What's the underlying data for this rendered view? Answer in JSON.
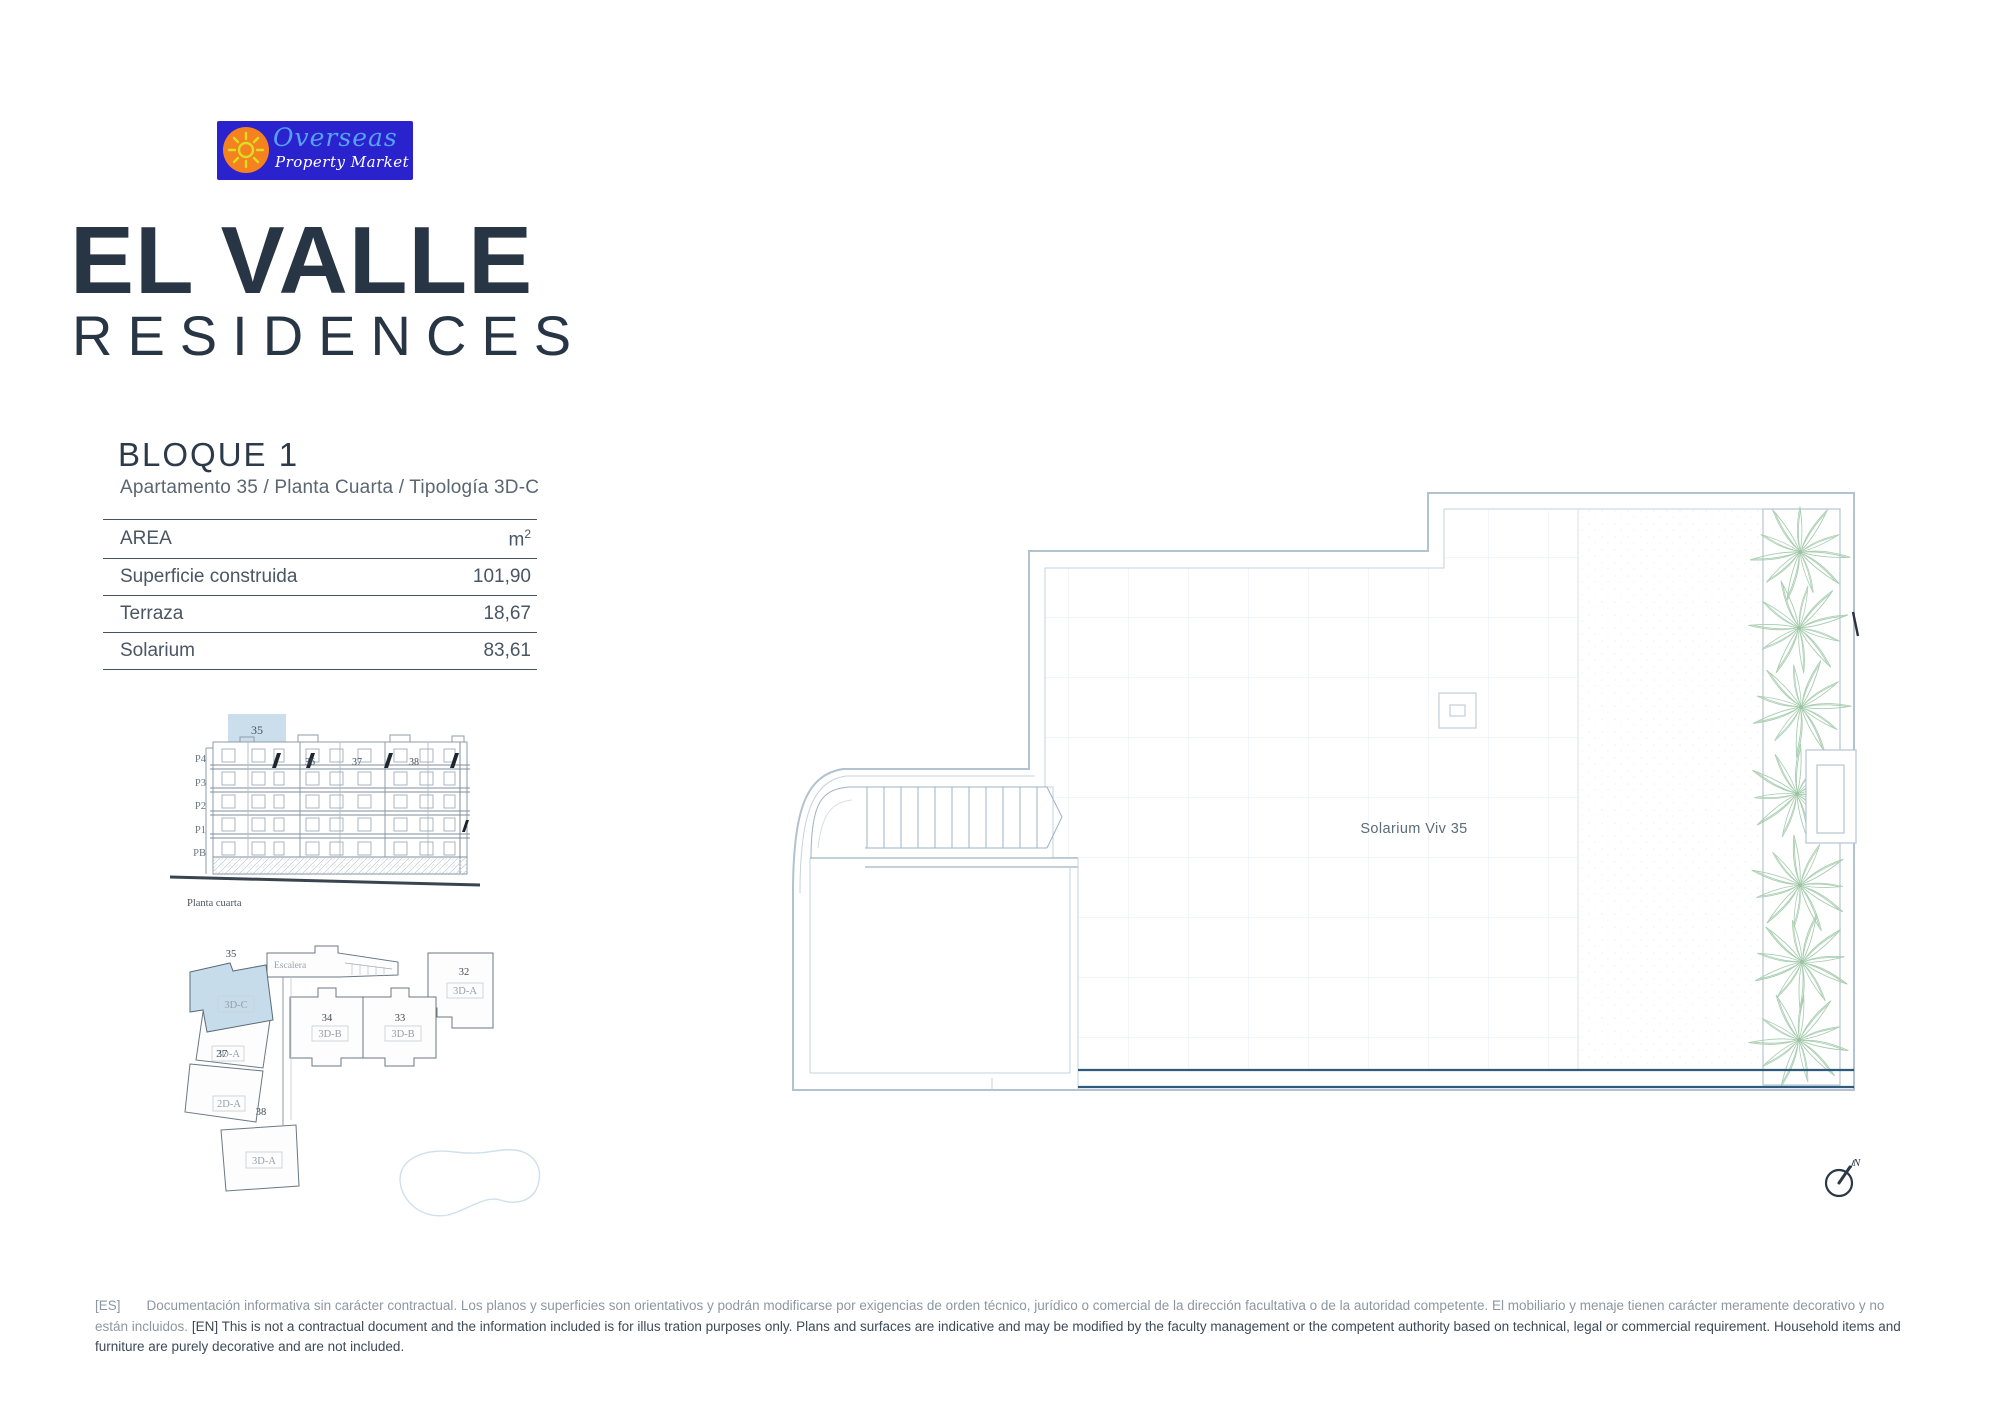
{
  "logo": {
    "line1": "Overseas",
    "line2": "Property Market",
    "colors": {
      "background": "#2a23cd",
      "sun_circle": "#f5821f",
      "sun_rays": "#d9e021",
      "line1_color": "#56a0f5",
      "line2_color": "#ffffff"
    }
  },
  "title": {
    "line1": "EL VALLE",
    "line2": "RESIDENCES",
    "color": "#273544"
  },
  "block": {
    "heading": "BLOQUE 1",
    "subtitle": "Apartamento 35 / Planta Cuarta / Tipología 3D-C"
  },
  "area_table": {
    "header": {
      "label": "AREA",
      "unit": "m",
      "unit_sup": "2"
    },
    "rows": [
      {
        "label": "Superficie construida",
        "value": "101,90"
      },
      {
        "label": "Terraza",
        "value": "18,67"
      },
      {
        "label": "Solarium",
        "value": "83,61"
      }
    ]
  },
  "elevation": {
    "floors": [
      "P4",
      "P3",
      "P2",
      "P1",
      "PB"
    ],
    "highlight_unit": "35",
    "unit_numbers": [
      "36",
      "37",
      "38"
    ],
    "caption": "Planta cuarta"
  },
  "key_plan": {
    "highlight_number": "35",
    "highlight_type": "3D-C",
    "stair_label": "Escalera",
    "units": [
      {
        "number": "34",
        "type": "3D-B"
      },
      {
        "number": "33",
        "type": "3D-B"
      },
      {
        "number": "32",
        "type": "3D-A"
      },
      {
        "number": "37",
        "type": "2D-A"
      },
      {
        "number": "",
        "type": "2D-A"
      },
      {
        "number": "38",
        "type": "3D-A"
      }
    ]
  },
  "floor_plan": {
    "room_label": "Solarium Viv 35",
    "compass_label": "N"
  },
  "disclaimer": {
    "es_tag": "[ES]",
    "es_text": "Documentación informativa sin carácter contractual. Los planos y superficies son orientativos y podrán modificarse por exigencias de orden técnico, jurídico o comercial de la dirección facultativa o de la autoridad competente. El mobiliario y menaje tienen carácter meramente decorativo y no están incluidos.",
    "en_tag": "[EN]",
    "en_text": "This is not a contractual document and the information included is for illus tration purposes only. Plans and surfaces are indicative and may be modified by the faculty management or the competent authority based on technical, legal or commercial requirement. Household items and furniture are purely decorative and are not included."
  }
}
